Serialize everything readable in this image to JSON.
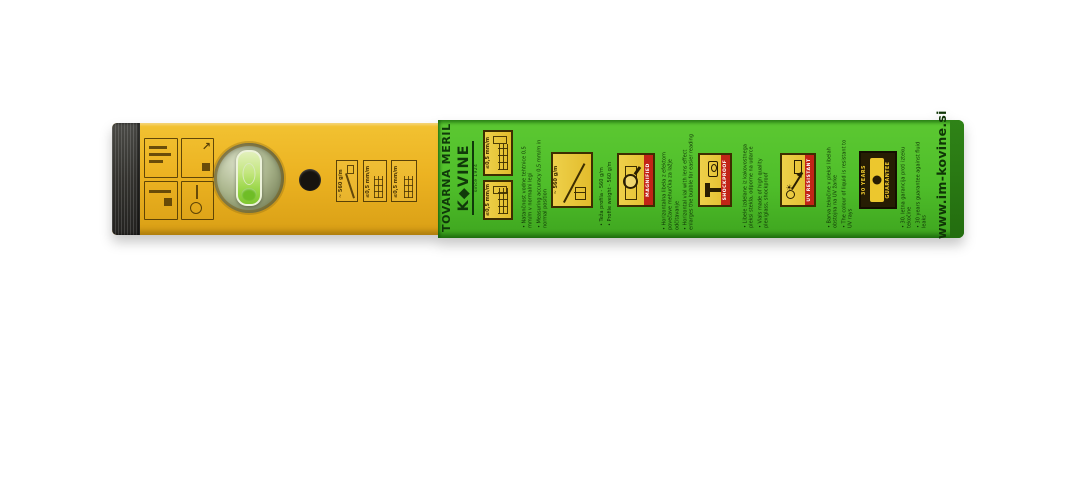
{
  "photo": {
    "colors": {
      "level_yellow": "#ecb322",
      "label_green": "#4fbe2a",
      "icon_box_yellow": "#e8c63a",
      "band_red": "#c22417",
      "dark_text_green": "#0f3506",
      "end_cap_dark": "#33322e"
    },
    "level": {
      "printed_specs": [
        {
          "label": "~ 560 g/m"
        },
        {
          "label": "≤0,5 mm/m"
        },
        {
          "label": "≤0,5 mm/m"
        }
      ]
    },
    "label": {
      "brand_top": "TOVARNA MERIL",
      "brand_logo": "K◆VINE",
      "brand_since": "since 1924",
      "website": "www.im-kovine.si",
      "icons": {
        "accuracy_horizontal": "≤0,5 mm/m",
        "accuracy_vertical": "≤0,5 mm/m",
        "profile_weight": "~ 560 g/m",
        "magnified": "MAGNIFIED",
        "shockproof": "SHOCKPROOF",
        "uv_resistant": "UV RESISTANT",
        "guarantee_years": "30 YEARS",
        "guarantee": "GUARANTEE"
      },
      "bullets": [
        {
          "si": "• Natančnost vodne tehtnice 0,5 mm/m v normalni legi",
          "en": "• Measuring accuracy 0,5 mm/m in normal position"
        },
        {
          "si": "• Teža profila - 560 g/m",
          "en": "• Profile weight - 560 g/m"
        },
        {
          "si": "• Horizontalna libela z efektom povečave mehurčka za lažje odčitavanje",
          "en": "• Horizontal vial with lens effect enlarges the bubble for easier reading"
        },
        {
          "si": "• Libele izdelane iz kakovostnega pleksi stekla, odporne na udarce",
          "en": "• Vials made of high quality plexiglass, shockproof"
        },
        {
          "si": "• Barva tekočine v pleksi libelah obstojna na UV žarke",
          "en": "• The colour of liquid is resistant to UV rays"
        },
        {
          "si": "• 30. letna garancija proti izteku tekočine",
          "en": "• 30 years guarantee against fluid leaks"
        }
      ]
    }
  }
}
